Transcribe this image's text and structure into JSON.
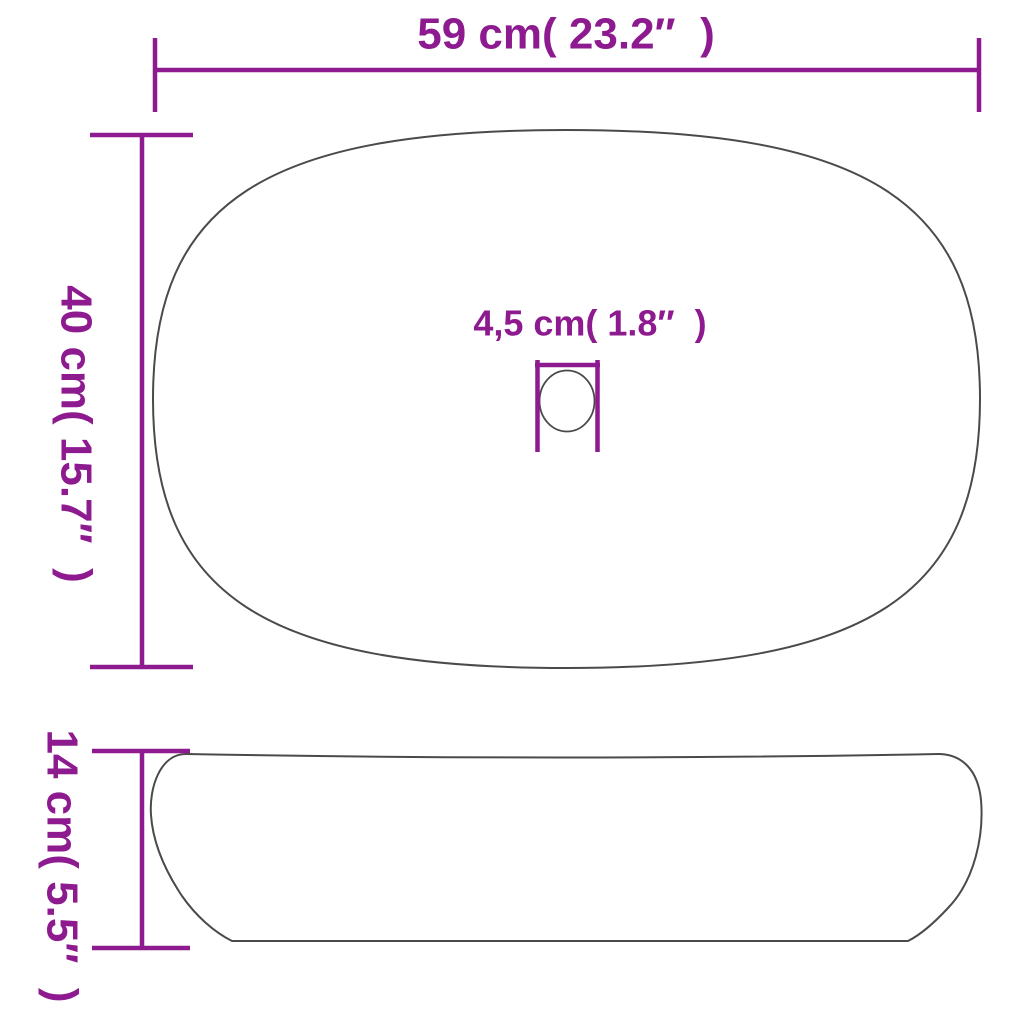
{
  "diagram": {
    "type": "product-dimension-drawing",
    "subject": "oval-countertop-basin",
    "views": [
      "top-view",
      "side-view"
    ]
  },
  "colors": {
    "dimension": "#8e1a90",
    "outline": "#4a4a4a",
    "background": "#ffffff"
  },
  "labels": {
    "width": "59 cm( 23.2″  )",
    "depth": "40 cm( 15.7″  )",
    "drain": "4,5 cm( 1.8″  )",
    "height": "14 cm( 5.5″  )"
  },
  "measurements": {
    "width_cm": "59",
    "width_inch": "23.2″",
    "depth_cm": "40",
    "depth_inch": "15.7″",
    "drain_cm": "4,5",
    "drain_inch": "1.8″",
    "height_cm": "14",
    "height_inch": "5.5″"
  }
}
